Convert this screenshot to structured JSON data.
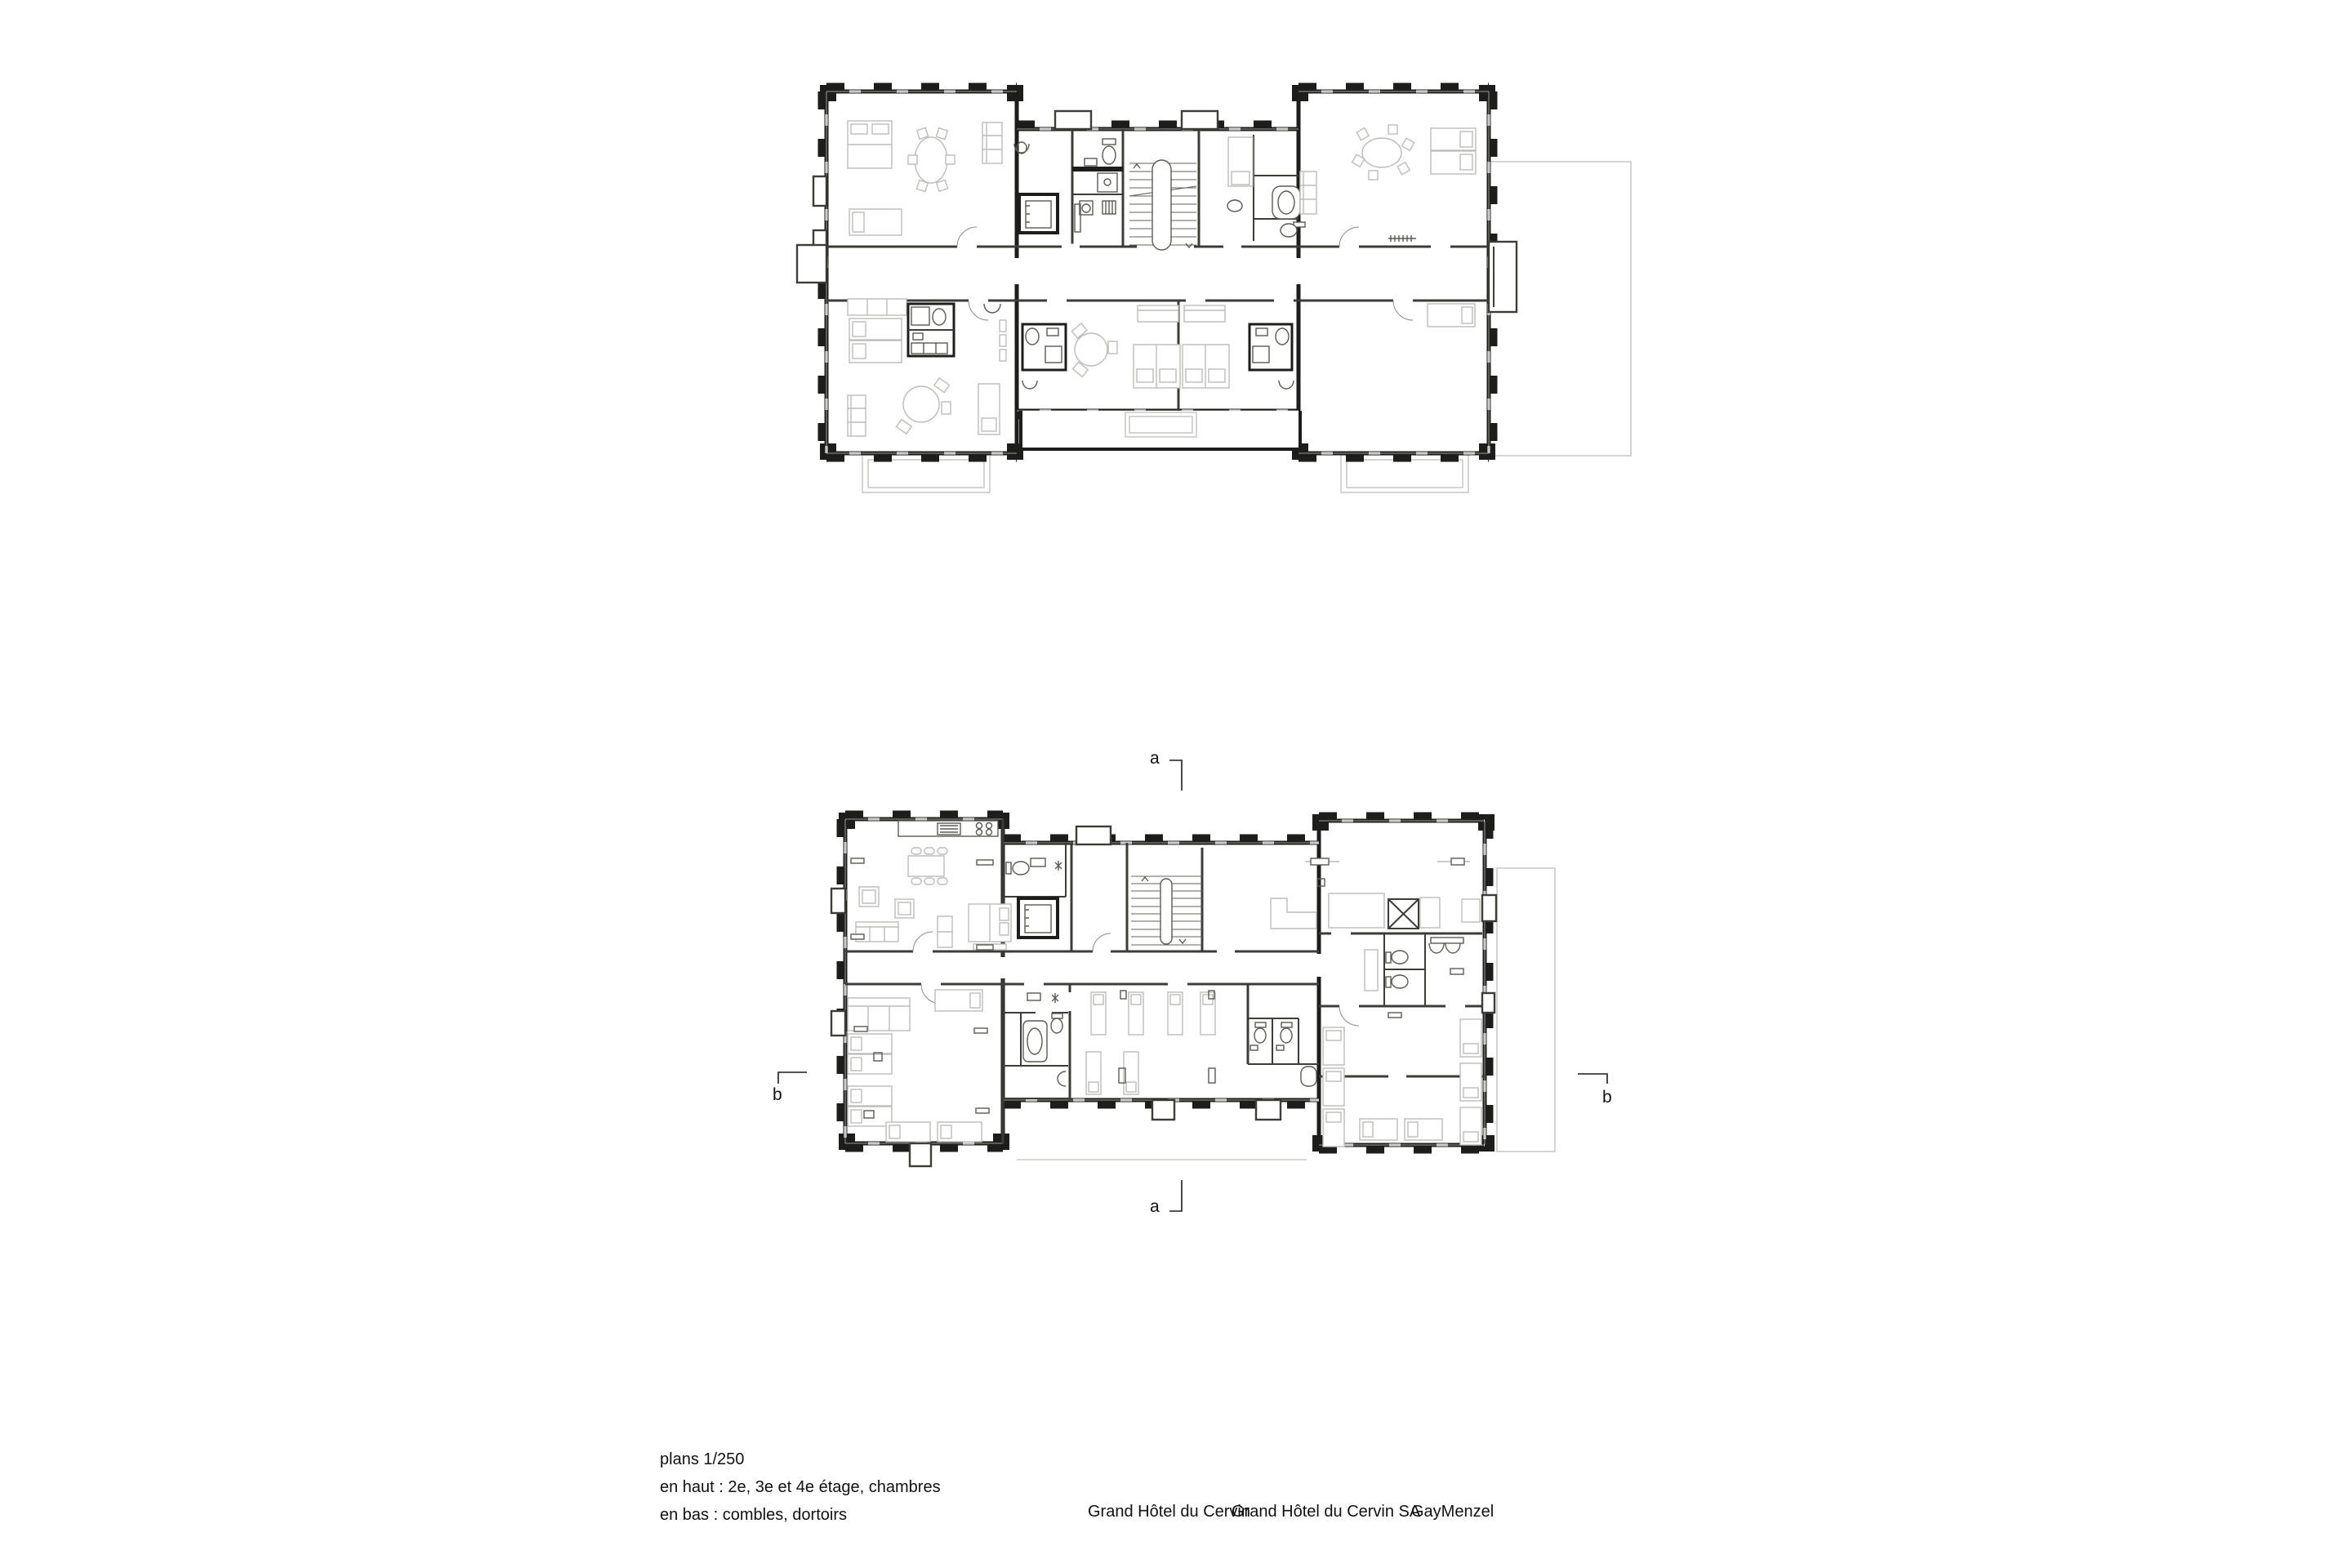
{
  "captions": {
    "scale_label": "plans 1/250",
    "line_top": "en haut : 2e, 3e et 4e étage, chambres",
    "line_bottom": "en bas : combles, dortoirs"
  },
  "footer": {
    "project": "Grand Hôtel du Cervin",
    "client": "Grand Hôtel du Cervin SA",
    "studio": "GayMenzel"
  },
  "section_markers": {
    "a_top": "a",
    "a_bottom": "a",
    "b_left": "b",
    "b_right": "b"
  },
  "colors": {
    "wall": "#1d1d1b",
    "partition": "#3c3c38",
    "fixture": "#5a5a54",
    "furniture": "#bcbcb8",
    "roofline": "#cacac6",
    "window": "#9a9a96",
    "door_arc": "#8a8a86",
    "text": "#111111"
  }
}
